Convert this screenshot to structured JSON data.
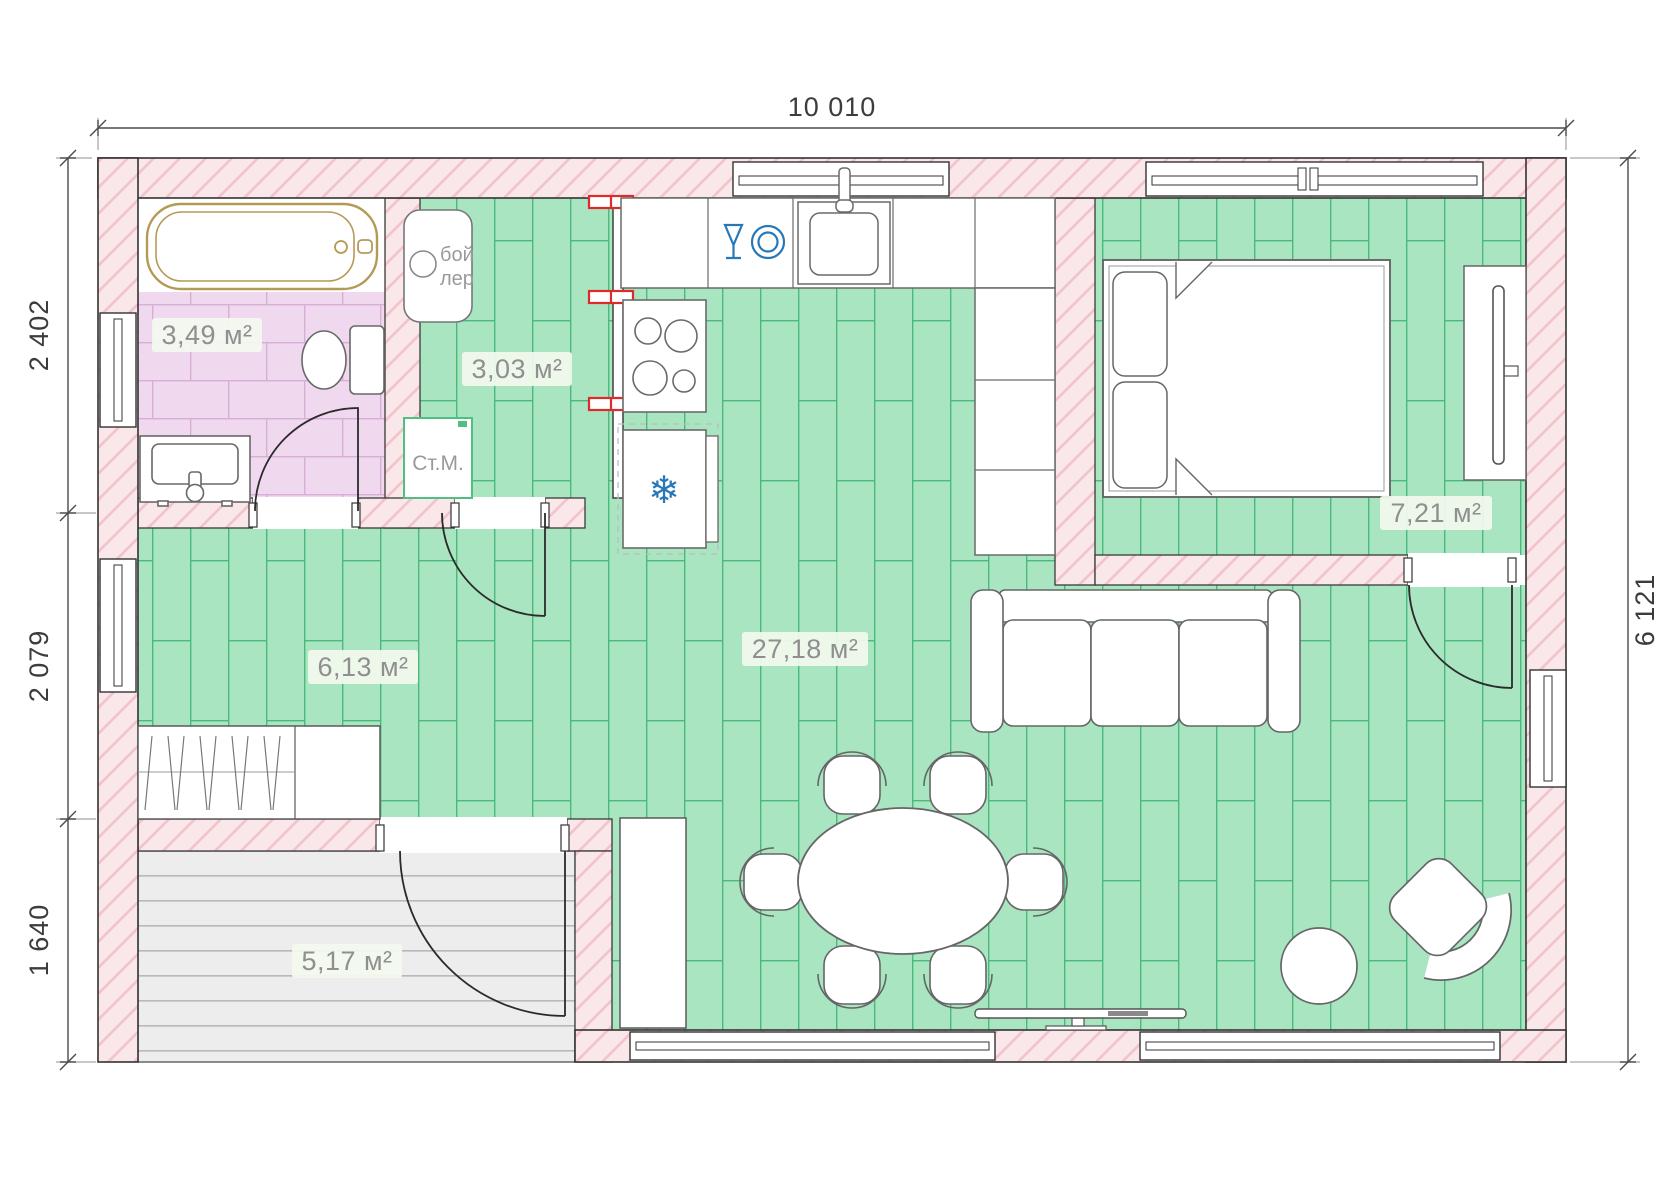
{
  "page": {
    "type": "architectural floor plan, single-storey house"
  },
  "dimensions": {
    "top": "10 010",
    "right": "6 121",
    "left_segments": [
      "2 402",
      "2 079",
      "1 640"
    ]
  },
  "rooms": {
    "bathroom": {
      "area": "3,49 м²"
    },
    "boiler_room": {
      "area": "3,03 м²"
    },
    "hallway": {
      "area": "6,13 м²"
    },
    "living_kitchen": {
      "area": "27,18 м²"
    },
    "bedroom": {
      "area": "7,21 м²"
    },
    "terrace": {
      "area": "5,17 м²"
    }
  },
  "equipment": {
    "boiler_line1": "бой",
    "boiler_line2": "лер",
    "washing_machine": "Ст.М.",
    "fridge_icon": "❄"
  },
  "colors": {
    "wall_fill": "#f9e7e9",
    "wall_hatch": "#f3c3cd",
    "floor_green": "#a9e5c1",
    "floor_green_line": "#49ba7c",
    "tile_pink": "#f0d9ef",
    "tile_pink_line": "#d6aed6",
    "deck_gray": "#ededed",
    "icon_blue": "#2878b8",
    "radiator_red": "#e02a2a",
    "tub_gold": "#b49a57"
  }
}
